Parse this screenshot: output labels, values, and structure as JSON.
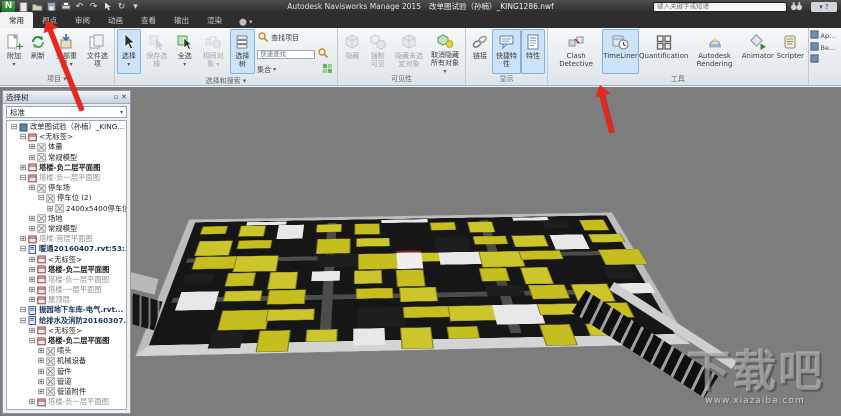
{
  "title_bar": {
    "app": "Autodesk Navisworks Manage 2015",
    "doc": "改单图试验（孙楠）_KING1286.nwf",
    "search_placeholder": "键入关键字或短语"
  },
  "ribbon": {
    "tabs": [
      {
        "id": "home",
        "label": "常用",
        "active": true
      },
      {
        "id": "viewpoint",
        "label": "视点",
        "active": false
      },
      {
        "id": "review",
        "label": "审阅",
        "active": false
      },
      {
        "id": "animation",
        "label": "动画",
        "active": false
      },
      {
        "id": "view",
        "label": "查看",
        "active": false
      },
      {
        "id": "output",
        "label": "输出",
        "active": false
      },
      {
        "id": "render",
        "label": "渲染",
        "active": false
      }
    ],
    "quick_find_placeholder": "快速查找",
    "groups": [
      {
        "id": "project",
        "label": "项目",
        "label_dropdown": true,
        "items": [
          {
            "id": "append",
            "icon": "append",
            "label": "附加",
            "dropdown": true,
            "state": "normal"
          },
          {
            "id": "refresh",
            "icon": "refresh",
            "label": "刷新",
            "state": "normal"
          },
          {
            "id": "reset-all",
            "icon": "reset",
            "label": "全部重置",
            "dropdown": true,
            "state": "normal"
          },
          {
            "id": "file-options",
            "icon": "fileopts",
            "label": "文件选项",
            "state": "normal"
          }
        ]
      },
      {
        "id": "select-search",
        "label": "选择和搜索",
        "label_dropdown": true,
        "items": [
          {
            "id": "select",
            "icon": "cursor",
            "label": "选择",
            "dropdown": true,
            "state": "active"
          },
          {
            "id": "save-selection",
            "icon": "cursorsave",
            "label": "保存选择",
            "state": "disabled"
          },
          {
            "id": "select-all",
            "icon": "selectall",
            "label": "全选",
            "dropdown": true,
            "state": "normal"
          },
          {
            "id": "select-same",
            "icon": "sameobj",
            "label": "相同对象",
            "dropdown": true,
            "state": "disabled"
          },
          {
            "id": "selection-tree",
            "icon": "seltree",
            "label": "选择树",
            "state": "active"
          }
        ],
        "find": {
          "find_label": "查找项目",
          "sets_label": "集合"
        }
      },
      {
        "id": "visibility",
        "label": "可见性",
        "items": [
          {
            "id": "hide",
            "icon": "cube",
            "label": "隐藏",
            "state": "disabled"
          },
          {
            "id": "require",
            "icon": "cubes2",
            "label": "强制可见",
            "state": "disabled"
          },
          {
            "id": "hide-unselected",
            "icon": "cube",
            "label": "隐藏未选定对象",
            "state": "disabled"
          },
          {
            "id": "unhide-all",
            "icon": "unhide",
            "label": "取消隐藏所有对象",
            "dropdown": true,
            "state": "normal"
          }
        ]
      },
      {
        "id": "display",
        "label": "显示",
        "items": [
          {
            "id": "links",
            "icon": "links",
            "label": "链接",
            "state": "normal"
          },
          {
            "id": "quick-properties",
            "icon": "quickprop",
            "label": "快捷特性",
            "state": "active"
          },
          {
            "id": "properties",
            "icon": "props",
            "label": "特性",
            "state": "active"
          }
        ]
      },
      {
        "id": "tools",
        "label": "工具",
        "items": [
          {
            "id": "clash-detective",
            "icon": "clash",
            "label": "Clash Detective",
            "state": "normal"
          },
          {
            "id": "timeliner",
            "icon": "timeliner",
            "label": "TimeLiner",
            "state": "active"
          },
          {
            "id": "quantification",
            "icon": "quant",
            "label": "Quantification",
            "state": "normal"
          },
          {
            "id": "autodesk-rendering",
            "icon": "rendering",
            "label": "Autodesk Rendering",
            "state": "normal"
          },
          {
            "id": "animator",
            "icon": "animator",
            "label": "Animator",
            "state": "normal"
          },
          {
            "id": "scripter",
            "icon": "scripter",
            "label": "Scripter",
            "state": "normal"
          }
        ]
      }
    ],
    "mini_items": [
      {
        "id": "appearance-profiler",
        "label": "Ap..."
      },
      {
        "id": "batch-utility",
        "label": "Be..."
      },
      {
        "id": "datatools",
        "label": ""
      }
    ]
  },
  "panel": {
    "title": "选择树",
    "filter_value": "标准",
    "tree": [
      {
        "label": "改单图试验（孙楠）_KING...",
        "level": 0,
        "tog": "-",
        "icon": "root",
        "bold": false
      },
      {
        "label": "<无标签>",
        "level": 1,
        "tog": "-",
        "icon": "sheet"
      },
      {
        "label": "体量",
        "level": 2,
        "tog": "+",
        "icon": "geom"
      },
      {
        "label": "常规模型",
        "level": 2,
        "tog": "+",
        "icon": "geom"
      },
      {
        "label": "塔楼-负二层平面图",
        "level": 1,
        "tog": "+",
        "icon": "sheet",
        "bold": true
      },
      {
        "label": "塔楼-负一层平面图",
        "level": 1,
        "tog": "-",
        "icon": "sheet",
        "dim": true
      },
      {
        "label": "停车场",
        "level": 2,
        "tog": "+",
        "icon": "geom"
      },
      {
        "label": "停车位 (2)",
        "level": 3,
        "tog": "-",
        "icon": "geom"
      },
      {
        "label": "2400x5400停车位",
        "level": 4,
        "tog": "+",
        "icon": "geom"
      },
      {
        "label": "场地",
        "level": 2,
        "tog": "+",
        "icon": "geom"
      },
      {
        "label": "常规模型",
        "level": 2,
        "tog": "+",
        "icon": "geom"
      },
      {
        "label": "塔楼-首层平面图",
        "level": 1,
        "tog": "+",
        "icon": "sheet",
        "dim": true
      },
      {
        "label": "暖通20160407.rvt:53:...",
        "level": 1,
        "tog": "-",
        "icon": "file"
      },
      {
        "label": "<无标签>",
        "level": 2,
        "tog": "+",
        "icon": "sheet"
      },
      {
        "label": "塔楼-负二层平面图",
        "level": 2,
        "tog": "+",
        "icon": "sheet",
        "bold": true
      },
      {
        "label": "塔楼-负一层平面图",
        "level": 2,
        "tog": "+",
        "icon": "sheet",
        "dim": true
      },
      {
        "label": "塔楼-一层平面图",
        "level": 2,
        "tog": "+",
        "icon": "sheet",
        "dim": true
      },
      {
        "label": "屋顶层",
        "level": 2,
        "tog": "+",
        "icon": "sheet",
        "dim": true
      },
      {
        "label": "振园地下车库-电气.rvt...",
        "level": 1,
        "tog": "-",
        "icon": "file"
      },
      {
        "label": "给排水及消防20160307...",
        "level": 1,
        "tog": "-",
        "icon": "file"
      },
      {
        "label": "<无标签>",
        "level": 2,
        "tog": "+",
        "icon": "sheet"
      },
      {
        "label": "塔楼-负二层平面图",
        "level": 2,
        "tog": "-",
        "icon": "sheet",
        "bold": true
      },
      {
        "label": "喷头",
        "level": 3,
        "tog": "+",
        "icon": "geom"
      },
      {
        "label": "机械设备",
        "level": 3,
        "tog": "+",
        "icon": "geom"
      },
      {
        "label": "管件",
        "level": 3,
        "tog": "+",
        "icon": "geom"
      },
      {
        "label": "管道",
        "level": 3,
        "tog": "+",
        "icon": "geom"
      },
      {
        "label": "管道附件",
        "level": 3,
        "tog": "+",
        "icon": "geom"
      },
      {
        "label": "塔楼-负一层平面图",
        "level": 2,
        "tog": "+",
        "icon": "sheet",
        "dim": true
      }
    ]
  },
  "viewport": {
    "background": "#7d7d7d",
    "floor_color": "#161616",
    "edge_color": "#bdbdbd",
    "block_yellow": "#c6bd1f",
    "block_yellow_alt": "#cdc52c",
    "block_white": "#e8e8e8",
    "block_grey": "#8d8d8d"
  },
  "annotations": {
    "arrow_color": "#e8261d"
  },
  "watermark": {
    "title": "下载吧",
    "url": "www.xiazaiba.com"
  }
}
